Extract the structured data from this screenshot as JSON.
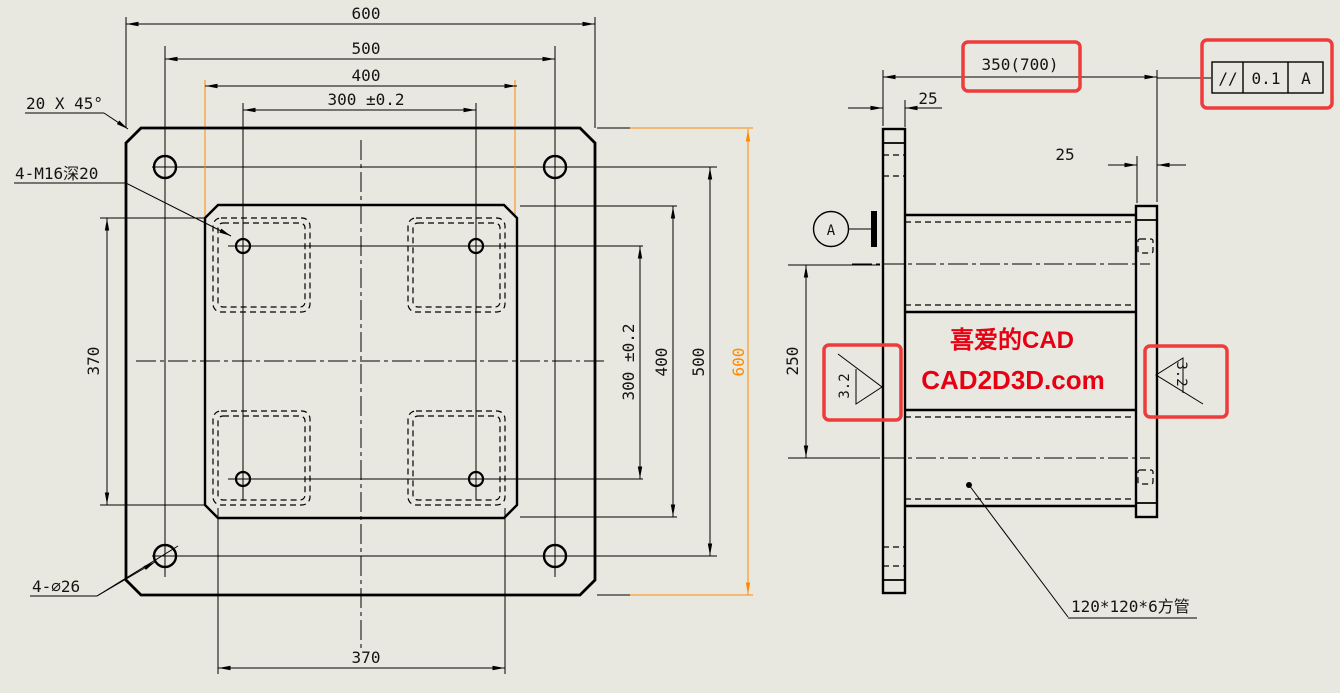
{
  "colors": {
    "background": "#e8e8e0",
    "line": "#000000",
    "selected_highlight_orange": "#ff8a00",
    "annotation_box_red": "#ee3b3b",
    "watermark_red": "#e60012"
  },
  "left_view": {
    "dims": {
      "top_600": "600",
      "top_500": "500",
      "top_400": "400",
      "top_300": "300 ±0.2",
      "right_300": "300 ±0.2",
      "right_400": "400",
      "right_500": "500",
      "right_600": "600",
      "left_370": "370",
      "bottom_370": "370"
    },
    "labels": {
      "chamfer": "20 X 45°",
      "tapped_holes": "4-M16深20",
      "through_holes": "4-∅26"
    }
  },
  "right_view": {
    "dims": {
      "length": "350(700)",
      "flange_left_thickness": "25",
      "flange_right_thickness": "25",
      "tube_spacing": "250"
    },
    "datum": "A",
    "fcf": {
      "symbol": "//",
      "tolerance": "0.1",
      "datum_ref": "A"
    },
    "roughness": {
      "left": "3.2",
      "right": "3.2"
    },
    "tube_note": "120*120*6方管"
  },
  "watermark": {
    "line1": "喜爱的CAD",
    "line2": "CAD2D3D.com"
  }
}
